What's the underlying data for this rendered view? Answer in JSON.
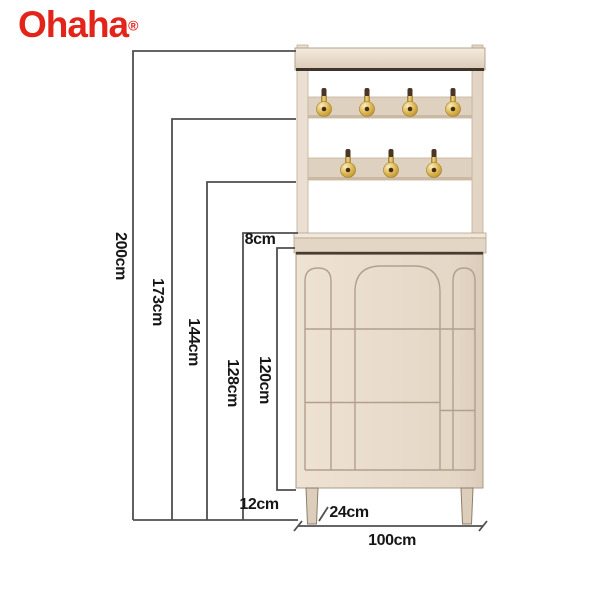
{
  "brand": {
    "name": "Ohaha",
    "registered_mark": "®",
    "logo_color": "#e2241a"
  },
  "diagram": {
    "type": "furniture-dimension-diagram",
    "product": "hallway shoe cabinet with coat hook panel",
    "dimensions": {
      "total_height": "200cm",
      "upper_hook_rail_height": "173cm",
      "lower_hook_rail_height": "144cm",
      "cabinet_with_top_shelf_height": "128cm",
      "cabinet_body_height": "120cm",
      "top_shelf_thickness": "8cm",
      "leg_height": "12cm",
      "depth": "24cm",
      "width": "100cm"
    },
    "hooks": {
      "upper_row_count": 4,
      "lower_row_count": 3
    },
    "colors": {
      "cabinet_beige": "#e8dccc",
      "rail_beige": "#dfd1bf",
      "hook_gold": "#caa043",
      "dimension_line_gray": "#4f4f4f"
    }
  }
}
